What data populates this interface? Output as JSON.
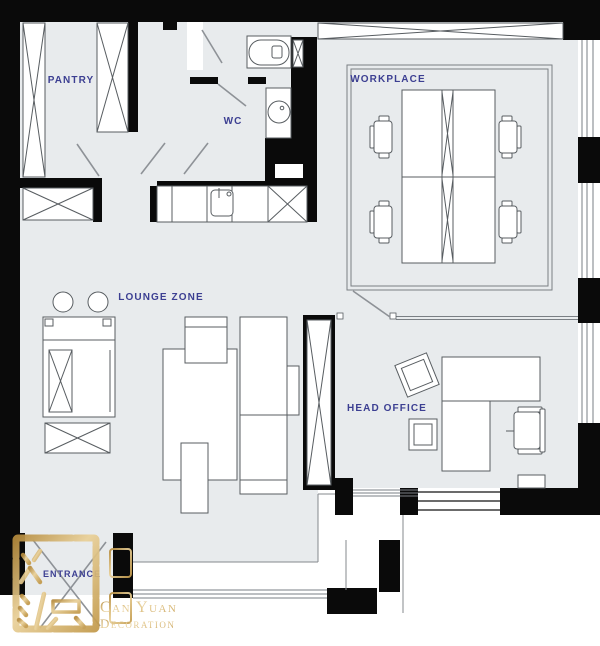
{
  "plan": {
    "rooms": {
      "pantry": {
        "label": "PANTRY"
      },
      "wc": {
        "label": "WC"
      },
      "workplace": {
        "label": "WORKPLACE"
      },
      "lounge": {
        "label": "LOUNGE ZONE"
      },
      "head_office": {
        "label": "HEAD OFFICE"
      },
      "entrance": {
        "label": "ENTRANCE"
      }
    },
    "furniture_icons": [
      "wardrobe-icon",
      "toilet-icon",
      "washbasin-icon",
      "kitchen-sink-icon",
      "appliance-icon",
      "desk-cluster-icon",
      "office-chair-icon",
      "sofa-icon",
      "coffee-table-icon",
      "stool-icon",
      "window-icon"
    ]
  },
  "logo": {
    "seal_characters": "灿源",
    "brand_name": "Can Yuan",
    "brand_suffix": "Decoration"
  },
  "colors": {
    "wall": "#0a0a0a",
    "floor": "#e8ebed",
    "room_label": "#3c3f92",
    "furniture_stroke": "#585d61",
    "logo_gold": "#c7a253",
    "background": "#ffffff"
  }
}
